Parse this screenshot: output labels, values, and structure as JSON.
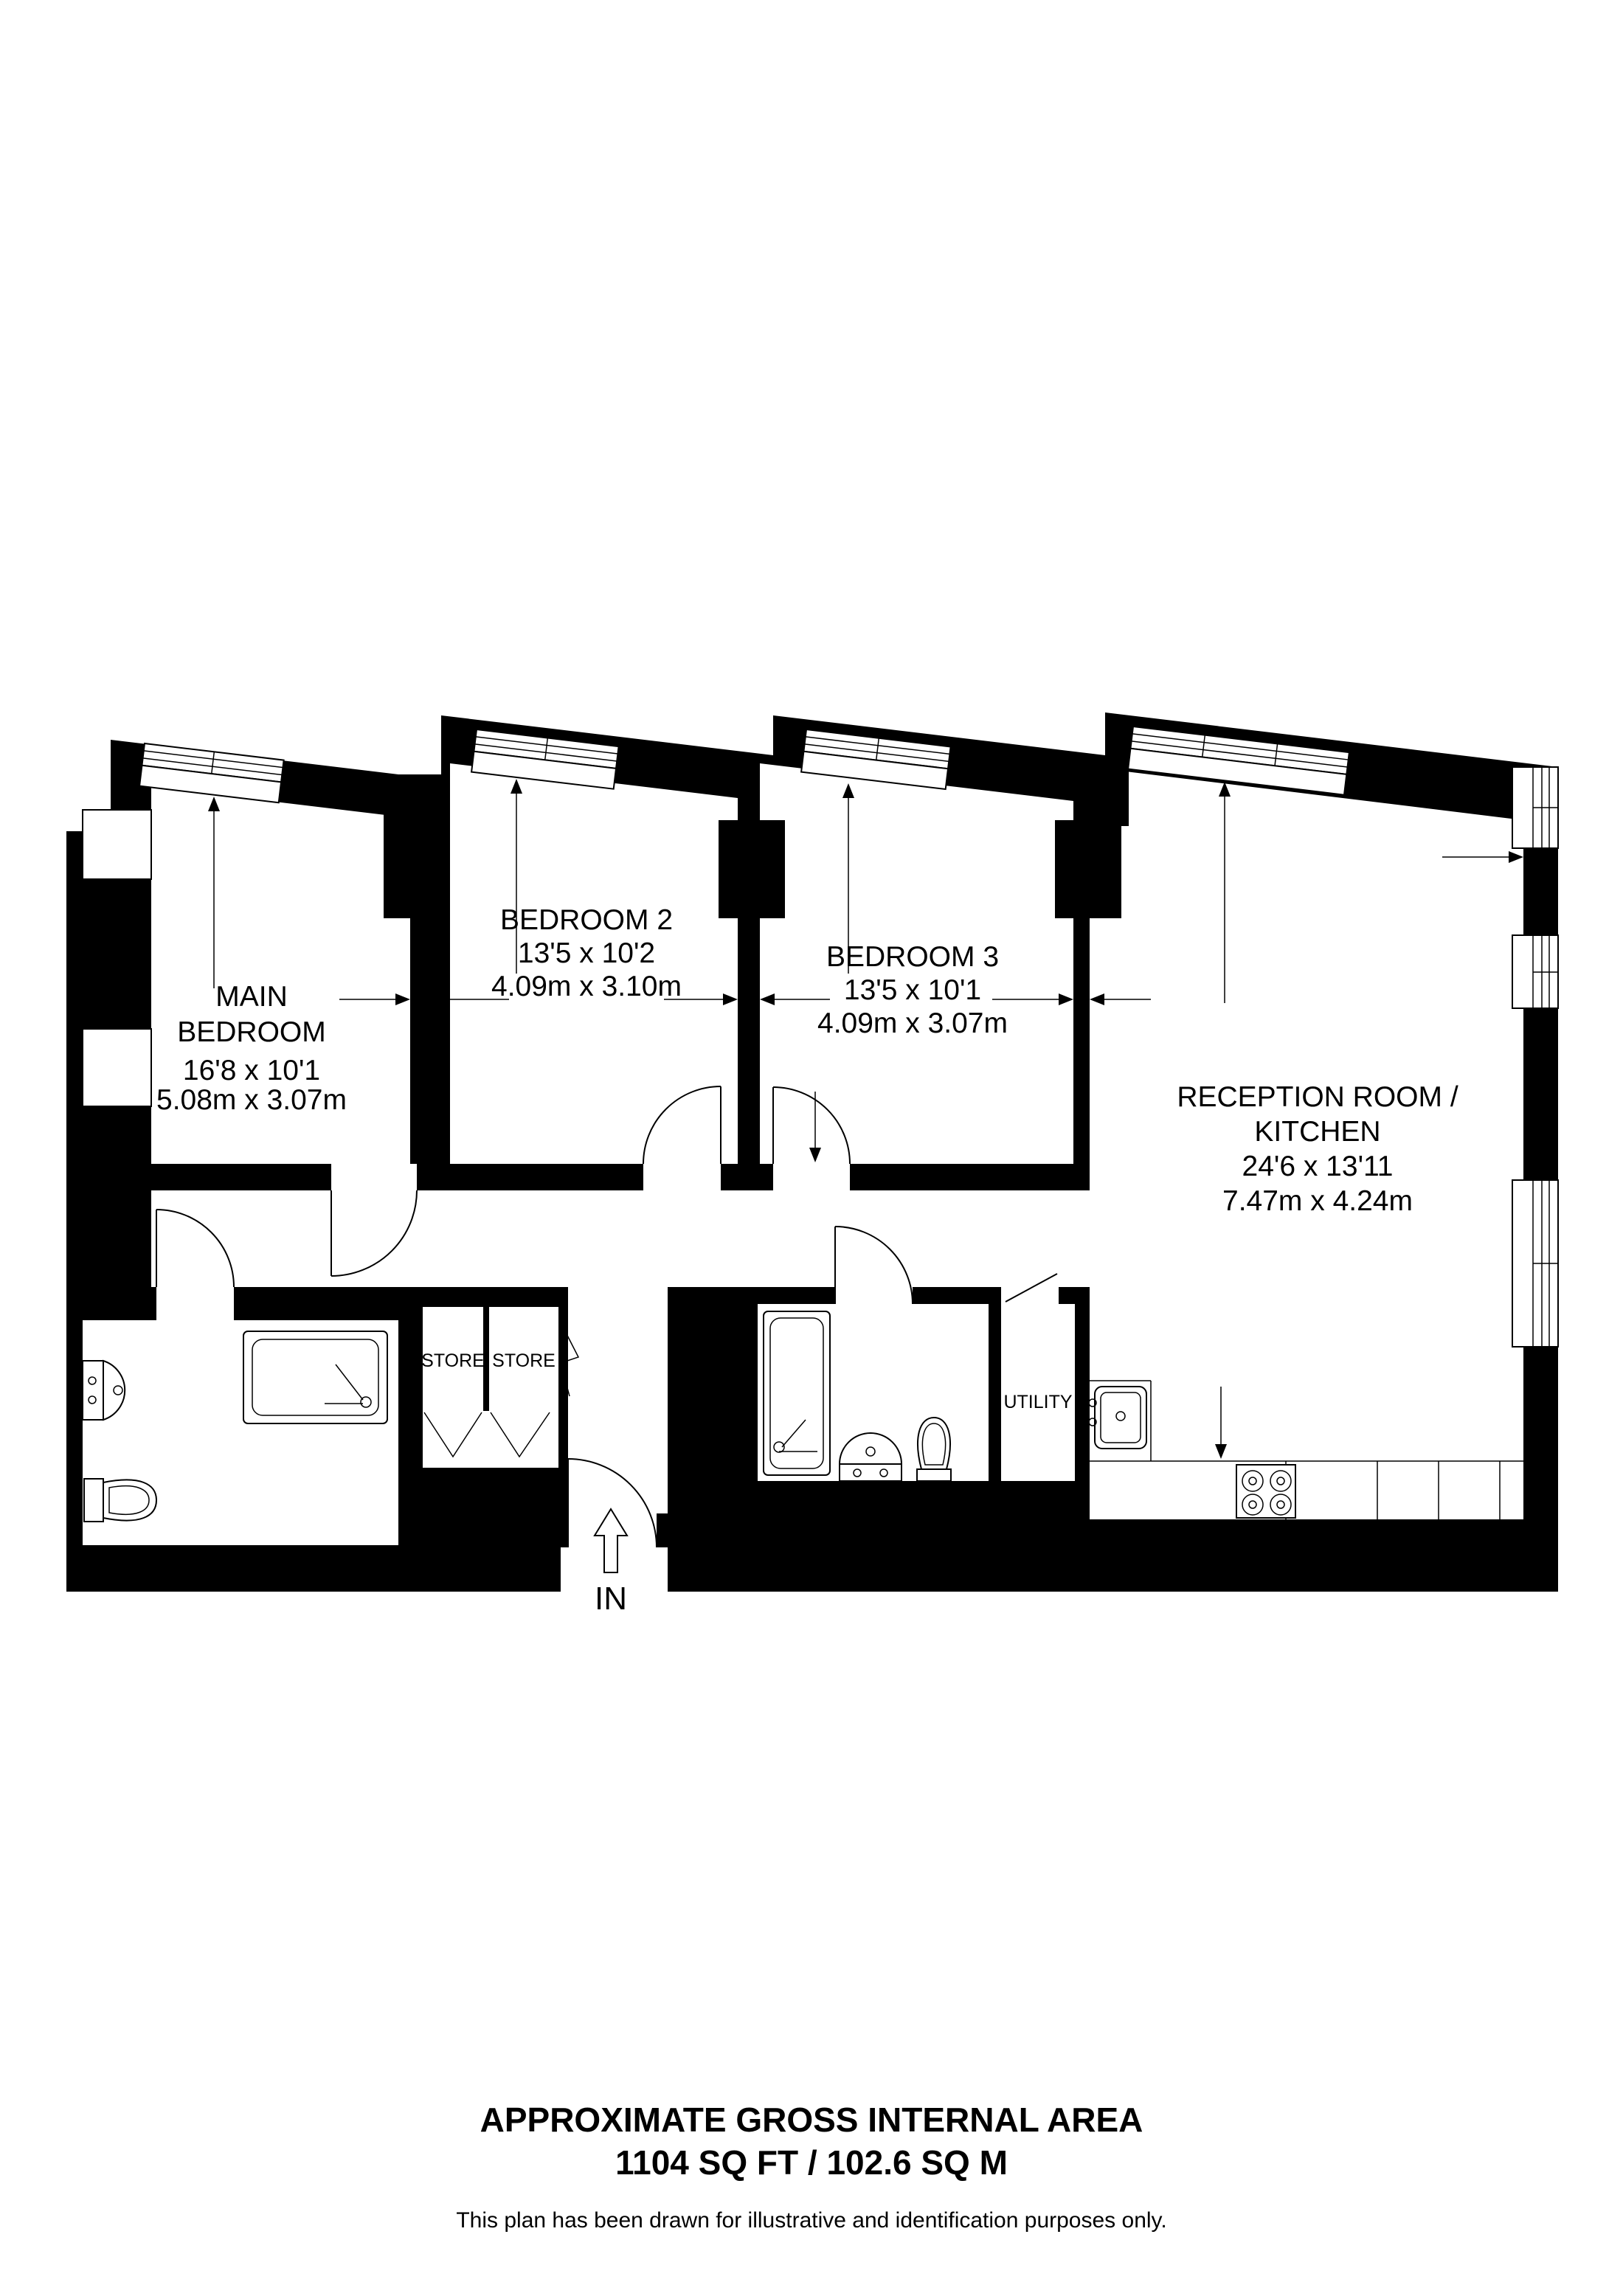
{
  "colors": {
    "wall": "#000000",
    "background": "#ffffff",
    "line": "#000000"
  },
  "rooms": {
    "main_bedroom": {
      "name_line1": "MAIN",
      "name_line2": "BEDROOM",
      "dims_imperial": "16'8 x 10'1",
      "dims_metric": "5.08m x 3.07m"
    },
    "bedroom2": {
      "name": "BEDROOM 2",
      "dims_imperial": "13'5 x 10'2",
      "dims_metric": "4.09m x 3.10m"
    },
    "bedroom3": {
      "name": "BEDROOM 3",
      "dims_imperial": "13'5 x 10'1",
      "dims_metric": "4.09m x 3.07m"
    },
    "reception": {
      "name_line1": "RECEPTION ROOM /",
      "name_line2": "KITCHEN",
      "dims_imperial": "24'6 x 13'11",
      "dims_metric": "7.47m x 4.24m"
    },
    "store_left": {
      "name": "STORE"
    },
    "store_right": {
      "name": "STORE"
    },
    "utility": {
      "name": "UTILITY"
    }
  },
  "entrance": {
    "label": "IN"
  },
  "footer": {
    "line1": "APPROXIMATE GROSS INTERNAL AREA",
    "line2": "1104 SQ FT / 102.6 SQ M",
    "disclaimer": "This plan has been drawn for illustrative and identification purposes only."
  },
  "fixtures": [
    "bathtub",
    "shower-bath",
    "basin",
    "toilet",
    "kitchen-sink",
    "hob",
    "store-folding-doors",
    "entrance-door",
    "windows"
  ]
}
